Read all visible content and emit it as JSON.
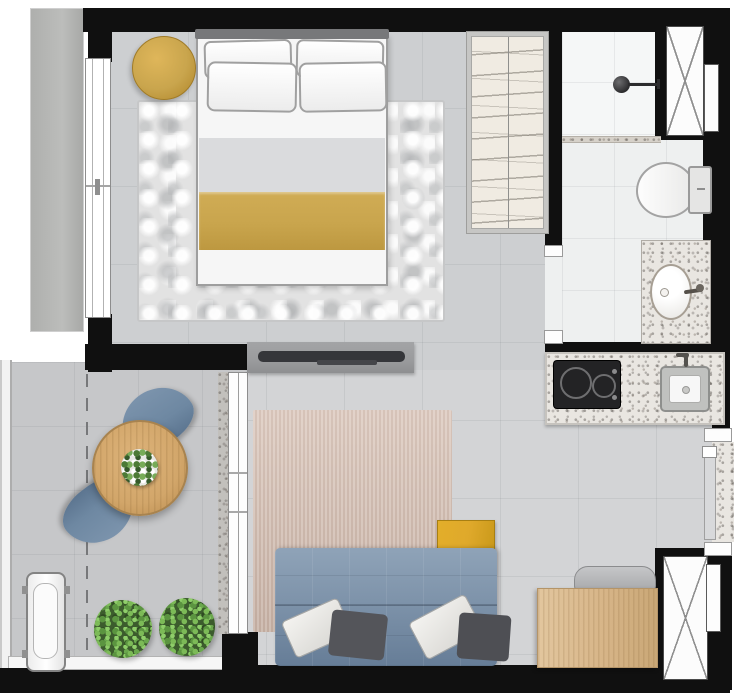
{
  "document": {
    "kind": "apartment-floor-plan",
    "style": "top-down rendered color plan, no text labels",
    "unit": "studio apartment with balcony at lower-left"
  },
  "palette": {
    "wall": "#101010",
    "floor_room": "#cdcfd1",
    "floor_living": "#d3d4d6",
    "floor_bath": "#eef0f0",
    "floor_balcony": "#c6c7c9",
    "rug_bedroom": "#e2e2e2",
    "rug_living_a": "#dcc9be",
    "rug_living_b": "#cdb6a9",
    "gold": "#c9a54d",
    "gold_bright": "#dfa92b",
    "wood_table": "#d2a66a",
    "wood_desk": "#d7b588",
    "sofa_blue": "#7e93aa",
    "chair_blue": "#6e88a2",
    "pillow_dark": "#54555a",
    "plant_green": "#5f9c45",
    "granite": "#e9e6e1",
    "steel": "#c0c1bf",
    "tv_panel": "#9a9b9d",
    "slab_gray": "#b5b6b4"
  },
  "rooms": [
    {
      "name": "bedroom",
      "furniture": [
        "double-bed-with-four-pillows",
        "gold-blanket-band",
        "mottled-gray-area-rug",
        "round-gold-ottoman",
        "wardrobe-with-hanging-rail"
      ]
    },
    {
      "name": "bathroom",
      "furniture": [
        "walk-in-shower-with-shower-head",
        "toilet-with-tank",
        "granite-vanity-with-oval-basin"
      ]
    },
    {
      "name": "kitchen",
      "furniture": [
        "granite-counter",
        "two-burner-cooktop",
        "stainless-sink-with-faucet"
      ]
    },
    {
      "name": "living-room",
      "furniture": [
        "blue-tufted-sofa",
        "two-white-and-two-dark-cushions",
        "gold-throw",
        "striped-beige-rug",
        "wall-mounted-tv-on-gray-panel",
        "wood-desk",
        "gray-desk-chair"
      ]
    },
    {
      "name": "balcony",
      "furniture": [
        "round-wood-table",
        "table-centerpiece-plant",
        "two-blue-lounge-chairs",
        "ac-condenser-unit",
        "two-potted-plants"
      ]
    }
  ],
  "fixtures_symbols": [
    "bedroom-window-left-wall",
    "sliding-glass-door-balcony",
    "bathroom-door-opening",
    "entry-door-opening-right-wall",
    "ventilation-shaft-x-top-right",
    "ventilation-shaft-x-bottom-right",
    "dashed-projection-line-balcony",
    "exterior-gray-slab-left"
  ]
}
